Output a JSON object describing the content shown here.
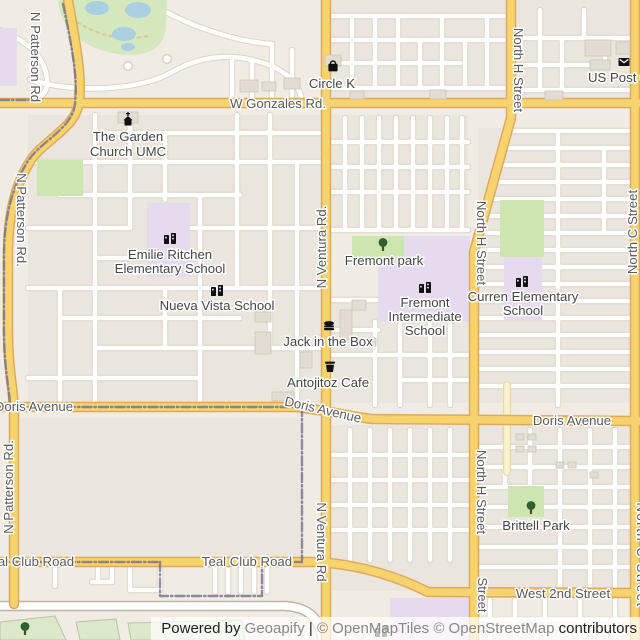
{
  "map": {
    "colors": {
      "background": "#F1ECE3",
      "block": "#EBE6DD",
      "street_fill": "#FFFFFF",
      "street_casing": "#D8D2C7",
      "road_yellow_fill": "#F7D36E",
      "road_yellow_casing": "#E0A85D",
      "road_cream_fill": "#FBF2D0",
      "road_cream_casing": "#E8D9A8",
      "big_road_fill": "#FFFFFF",
      "big_road_casing": "#BBB5A8",
      "park_green": "#CDE5AE",
      "golf_green": "#D5E7BD",
      "field_green": "#DBE8CA",
      "field_outline": "#B8C3A4",
      "school_purple": "#E6DAEF",
      "water_blue": "#A9CFE1",
      "sand_tan": "#D8C8A0",
      "boundary": "#70708F",
      "building_fill": "#E2DCD2",
      "building_outline": "#CBC4B8",
      "street_label_text": "#5A5A5A",
      "poi_label_text": "#454545",
      "icon_black": "#111111",
      "tree_green": "#306030",
      "halo": "#FFFFFF"
    },
    "blocks": [
      [
        332,
        0,
        176,
        100
      ],
      [
        515,
        0,
        121,
        100
      ],
      [
        28,
        115,
        292,
        288
      ],
      [
        332,
        115,
        136,
        115
      ],
      [
        478,
        128,
        156,
        275
      ],
      [
        332,
        300,
        136,
        103
      ],
      [
        332,
        425,
        138,
        166
      ],
      [
        475,
        425,
        159,
        166
      ],
      [
        20,
        418,
        282,
        142
      ]
    ],
    "streets_minor_h": [
      [
        332,
        16,
        508
      ],
      [
        332,
        40,
        508
      ],
      [
        332,
        63,
        460
      ],
      [
        332,
        88,
        508
      ],
      [
        515,
        38,
        634
      ],
      [
        515,
        65,
        600
      ],
      [
        515,
        90,
        634
      ],
      [
        95,
        133,
        320
      ],
      [
        28,
        162,
        320
      ],
      [
        60,
        195,
        240
      ],
      [
        28,
        228,
        130
      ],
      [
        190,
        228,
        320
      ],
      [
        95,
        258,
        200
      ],
      [
        28,
        288,
        320
      ],
      [
        60,
        318,
        240
      ],
      [
        95,
        348,
        320
      ],
      [
        28,
        378,
        200
      ],
      [
        332,
        142,
        468
      ],
      [
        332,
        167,
        468
      ],
      [
        332,
        192,
        468
      ],
      [
        332,
        230,
        468
      ],
      [
        332,
        300,
        378
      ],
      [
        332,
        330,
        378
      ],
      [
        332,
        355,
        470
      ],
      [
        400,
        380,
        470
      ],
      [
        509,
        131,
        634
      ],
      [
        506,
        148,
        634
      ],
      [
        501,
        165,
        634
      ],
      [
        496,
        182,
        634
      ],
      [
        491,
        199,
        634
      ],
      [
        486,
        216,
        634
      ],
      [
        481,
        233,
        634
      ],
      [
        477,
        250,
        634
      ],
      [
        478,
        267,
        634
      ],
      [
        478,
        284,
        634
      ],
      [
        478,
        301,
        634
      ],
      [
        478,
        318,
        634
      ],
      [
        478,
        335,
        634
      ],
      [
        478,
        352,
        634
      ],
      [
        478,
        369,
        634
      ],
      [
        478,
        386,
        634
      ],
      [
        332,
        455,
        470
      ],
      [
        332,
        480,
        470
      ],
      [
        332,
        505,
        470
      ],
      [
        332,
        530,
        470
      ],
      [
        475,
        447,
        634
      ],
      [
        475,
        467,
        634
      ],
      [
        475,
        487,
        634
      ],
      [
        475,
        507,
        634
      ],
      [
        475,
        527,
        634
      ],
      [
        475,
        547,
        634
      ],
      [
        475,
        567,
        634
      ],
      [
        475,
        620,
        630
      ]
    ],
    "streets_minor_v": [
      [
        352,
        16,
        88
      ],
      [
        375,
        16,
        88
      ],
      [
        398,
        16,
        88
      ],
      [
        420,
        40,
        88
      ],
      [
        442,
        16,
        88
      ],
      [
        465,
        40,
        88
      ],
      [
        487,
        16,
        88
      ],
      [
        540,
        10,
        90
      ],
      [
        562,
        38,
        90
      ],
      [
        584,
        10,
        38
      ],
      [
        605,
        38,
        65
      ],
      [
        232,
        58,
        100
      ],
      [
        252,
        60,
        100
      ],
      [
        272,
        46,
        100
      ],
      [
        292,
        50,
        100
      ],
      [
        95,
        115,
        405
      ],
      [
        130,
        115,
        228
      ],
      [
        165,
        133,
        200
      ],
      [
        200,
        195,
        405
      ],
      [
        237,
        115,
        288
      ],
      [
        270,
        115,
        348
      ],
      [
        297,
        162,
        405
      ],
      [
        60,
        288,
        405
      ],
      [
        165,
        288,
        348
      ],
      [
        345,
        118,
        230
      ],
      [
        362,
        118,
        230
      ],
      [
        379,
        118,
        230
      ],
      [
        396,
        118,
        230
      ],
      [
        413,
        118,
        230
      ],
      [
        430,
        118,
        230
      ],
      [
        447,
        118,
        230
      ],
      [
        462,
        118,
        230
      ],
      [
        375,
        322,
        405
      ],
      [
        400,
        322,
        405
      ],
      [
        430,
        322,
        405
      ],
      [
        450,
        322,
        405
      ],
      [
        558,
        131,
        405
      ],
      [
        604,
        148,
        233
      ],
      [
        350,
        430,
        560
      ],
      [
        370,
        430,
        560
      ],
      [
        390,
        430,
        560
      ],
      [
        410,
        430,
        560
      ],
      [
        430,
        430,
        560
      ],
      [
        450,
        430,
        560
      ],
      [
        505,
        430,
        485
      ],
      [
        530,
        430,
        485
      ],
      [
        560,
        430,
        590
      ],
      [
        590,
        430,
        590
      ],
      [
        615,
        430,
        590
      ],
      [
        490,
        600,
        640
      ],
      [
        515,
        600,
        640
      ],
      [
        545,
        600,
        640
      ],
      [
        580,
        600,
        640
      ],
      [
        615,
        600,
        640
      ],
      [
        55,
        566,
        586
      ],
      [
        98,
        566,
        582
      ],
      [
        215,
        566,
        592
      ],
      [
        228,
        566,
        592
      ],
      [
        241,
        566,
        592
      ],
      [
        254,
        566,
        592
      ],
      [
        267,
        566,
        592
      ]
    ],
    "streets_minor_paths": [
      "M0,30 C30,42 44,58 47,78 C49,92 40,100 28,103",
      "M30,80 C80,94 140,90 172,72 C200,56 228,54 252,60 C280,66 300,80 302,103",
      "M150,2 C185,26 238,42 272,44",
      "M130,564 V590 H160 V564",
      "M92,582 H112 V566"
    ],
    "street_bulbs": [
      [
        128,
        66
      ],
      [
        167,
        59
      ]
    ],
    "roads_major": [
      {
        "name": "w-gonzales-rd",
        "d": "M0,103 H640"
      },
      {
        "name": "n-ventura-rd",
        "d": "M326,0 V640"
      },
      {
        "name": "north-h-street",
        "d": "M511,0 V118 L474,252 V640"
      },
      {
        "name": "doris-avenue",
        "d": "M0,407 H295 C325,410 348,416 372,419 L640,421"
      },
      {
        "name": "teal-club-road-west-2nd-street",
        "d": "M0,562 H318 C362,565 398,577 428,592 L640,593"
      },
      {
        "name": "n-patterson-rd",
        "d": "M68,0 C76,45 82,75 79,102 C76,128 44,140 31,160 C15,184 8,215 8,255 L8,330 C8,368 13,388 14,408 L14,604"
      },
      {
        "name": "north-c-street",
        "d": "M635,0 V640"
      }
    ],
    "roads_cream": [
      {
        "name": "minor-tertiary-road",
        "d": "M507,385 V472"
      }
    ],
    "big_road": {
      "name": "wide-road",
      "d": "M0,606 H286 C312,608 321,622 322,640"
    },
    "boundary_paths": [
      "M0,100 H30",
      "M63,4 C72,48 78,77 75,104 C72,129 41,141 28,161 C13,185 4,216 4,256 L4,330 C4,367 9,387 10,404",
      "M0,407 H302",
      "M302,407 V560",
      "M0,562 H160",
      "M160,562 V596 H262 V562",
      "M262,562 H302"
    ],
    "areas": {
      "golf_course": "M58,0 C60,26 78,46 112,53 C142,59 163,52 166,28 L167,0 Z",
      "golf_sand_path": "M72,18 C92,34 120,42 148,36",
      "ponds": [
        [
          97,
          8,
          12,
          7
        ],
        [
          138,
          10,
          13,
          8
        ],
        [
          124,
          34,
          12,
          7
        ],
        [
          128,
          47,
          7,
          4
        ]
      ],
      "parks_rects": [
        {
          "name": "park-mid-left",
          "r": [
            37,
            160,
            46,
            36
          ]
        },
        {
          "name": "fremont-park-green",
          "r": [
            352,
            236,
            57,
            30
          ]
        },
        {
          "name": "green-north-of-curren",
          "r": [
            500,
            200,
            44,
            57
          ]
        },
        {
          "name": "brittell-park-green",
          "r": [
            508,
            486,
            36,
            31
          ]
        }
      ],
      "school_rects": [
        {
          "name": "school-grounds-left-edge",
          "r": [
            0,
            28,
            17,
            58
          ]
        },
        {
          "name": "emilie-ritchen-grounds",
          "r": [
            147,
            203,
            43,
            74
          ]
        },
        {
          "name": "curren-grounds",
          "r": [
            504,
            257,
            38,
            63
          ]
        },
        {
          "name": "school-grounds-bottom",
          "r": [
            390,
            598,
            80,
            42
          ]
        }
      ],
      "school_paths": [
        {
          "name": "fremont-intermediate-grounds",
          "d": "M404,236 H470 V322 H378 V260 L404,256 Z"
        }
      ],
      "fields": [
        [
          [
            0,
            622
          ],
          [
            55,
            616
          ],
          [
            66,
            640
          ],
          [
            0,
            640
          ]
        ],
        [
          [
            76,
            622
          ],
          [
            116,
            619
          ],
          [
            120,
            640
          ],
          [
            80,
            640
          ]
        ],
        [
          [
            128,
            623
          ],
          [
            242,
            620
          ],
          [
            245,
            640
          ],
          [
            131,
            640
          ]
        ]
      ]
    },
    "buildings": [
      [
        240,
        80,
        18,
        12
      ],
      [
        262,
        82,
        14,
        9
      ],
      [
        284,
        78,
        16,
        11
      ],
      [
        350,
        91,
        14,
        8
      ],
      [
        430,
        90,
        16,
        9
      ],
      [
        545,
        91,
        18,
        9
      ],
      [
        585,
        40,
        26,
        16
      ],
      [
        616,
        42,
        14,
        12
      ],
      [
        590,
        60,
        20,
        10
      ],
      [
        325,
        55,
        16,
        11
      ],
      [
        118,
        112,
        20,
        11
      ],
      [
        255,
        312,
        16,
        10
      ],
      [
        255,
        332,
        16,
        22
      ],
      [
        272,
        392,
        22,
        9
      ],
      [
        300,
        352,
        12,
        16
      ],
      [
        340,
        310,
        12,
        30
      ],
      [
        352,
        300,
        14,
        10
      ],
      [
        366,
        338,
        10,
        8
      ],
      [
        516,
        434,
        8,
        6
      ],
      [
        528,
        434,
        8,
        6
      ],
      [
        516,
        446,
        8,
        6
      ],
      [
        528,
        446,
        8,
        6
      ],
      [
        556,
        462,
        8,
        6
      ],
      [
        568,
        462,
        8,
        6
      ],
      [
        590,
        472,
        8,
        6
      ]
    ],
    "street_labels": [
      {
        "t": "W Gonzales Rd.",
        "x": 278,
        "y": 108,
        "mode": "h"
      },
      {
        "t": "Doris Avenue",
        "x": 34,
        "y": 411,
        "mode": "h"
      },
      {
        "t": "Doris Avenue",
        "x": 322,
        "y": 414,
        "mode": "rot",
        "deg": 13
      },
      {
        "t": "Doris Avenue",
        "x": 572,
        "y": 425,
        "mode": "h"
      },
      {
        "t": "Teal Club Road",
        "x": 29,
        "y": 566,
        "mode": "h"
      },
      {
        "t": "Teal Club Road",
        "x": 247,
        "y": 566,
        "mode": "h"
      },
      {
        "t": "West 2nd Street",
        "x": 563,
        "y": 598,
        "mode": "h"
      },
      {
        "t": "N Patterson Rd",
        "x": 31,
        "y": 57,
        "mode": "down"
      },
      {
        "t": "N Patterson Rd.",
        "x": 17,
        "y": 220,
        "mode": "down"
      },
      {
        "t": "N Patterson Rd.",
        "x": 13,
        "y": 487,
        "mode": "up"
      },
      {
        "t": "N Ventura Rd.",
        "x": 326,
        "y": 247,
        "mode": "up"
      },
      {
        "t": "N Ventura Rd",
        "x": 317,
        "y": 542,
        "mode": "down"
      },
      {
        "t": "North H Street",
        "x": 514,
        "y": 70,
        "mode": "down"
      },
      {
        "t": "North H Street",
        "x": 477,
        "y": 243,
        "mode": "down"
      },
      {
        "t": "North H Street",
        "x": 477,
        "y": 492,
        "mode": "down"
      },
      {
        "t": "Street",
        "x": 478,
        "y": 595,
        "mode": "down"
      },
      {
        "t": "North C Street",
        "x": 637,
        "y": 232,
        "mode": "up"
      },
      {
        "t": "North C Street",
        "x": 637,
        "y": 555,
        "mode": "down",
        "ls": 1.5
      }
    ],
    "pois": [
      {
        "name": "circle-k",
        "icon": "bag",
        "ix": 333,
        "iy": 67,
        "lines": [
          {
            "t": "Circle K",
            "x": 332,
            "y": 88
          }
        ]
      },
      {
        "name": "us-post-office",
        "icon": "envelope",
        "ix": 624,
        "iy": 62,
        "lines": [
          {
            "t": "US Post Of",
            "x": 621,
            "y": 82
          }
        ]
      },
      {
        "name": "the-garden-church-umc",
        "icon": "church",
        "ix": 128,
        "iy": 121,
        "lines": [
          {
            "t": "The Garden",
            "x": 128,
            "y": 141
          },
          {
            "t": "Church UMC",
            "x": 128,
            "y": 156
          }
        ]
      },
      {
        "name": "emilie-ritchen-elementary-school",
        "icon": "school",
        "ix": 170,
        "iy": 239,
        "lines": [
          {
            "t": "Emilie Ritchen",
            "x": 170,
            "y": 259
          },
          {
            "t": "Elementary School",
            "x": 170,
            "y": 273
          }
        ]
      },
      {
        "name": "nueva-vista-school",
        "icon": "school",
        "ix": 217,
        "iy": 291,
        "lines": [
          {
            "t": "Nueva Vista School",
            "x": 217,
            "y": 310
          }
        ]
      },
      {
        "name": "fremont-park",
        "icon": "tree",
        "ix": 383,
        "iy": 246,
        "lines": [
          {
            "t": "Fremont park",
            "x": 384,
            "y": 265
          }
        ]
      },
      {
        "name": "fremont-intermediate-school",
        "icon": "school",
        "ix": 425,
        "iy": 288,
        "lines": [
          {
            "t": "Fremont",
            "x": 425,
            "y": 307
          },
          {
            "t": "Intermediate",
            "x": 425,
            "y": 321
          },
          {
            "t": "School",
            "x": 425,
            "y": 335
          }
        ]
      },
      {
        "name": "curren-elementary-school",
        "icon": "school",
        "ix": 522,
        "iy": 282,
        "lines": [
          {
            "t": "Curren Elementary",
            "x": 523,
            "y": 301
          },
          {
            "t": "School",
            "x": 523,
            "y": 315
          }
        ]
      },
      {
        "name": "jack-in-the-box",
        "icon": "burger",
        "ix": 329,
        "iy": 326,
        "lines": [
          {
            "t": "Jack in the Box",
            "x": 328,
            "y": 346
          }
        ]
      },
      {
        "name": "antojitoz-cafe",
        "icon": "cup",
        "ix": 330,
        "iy": 367,
        "lines": [
          {
            "t": "Antojitoz Cafe",
            "x": 328,
            "y": 387
          }
        ]
      },
      {
        "name": "brittell-park",
        "icon": "tree",
        "ix": 531,
        "iy": 509,
        "lines": [
          {
            "t": "Brittell Park",
            "x": 536,
            "y": 530
          }
        ]
      },
      {
        "name": "school-bottom",
        "icon": "school",
        "ix": 381,
        "iy": 632,
        "lines": []
      },
      {
        "name": "field-tree",
        "icon": "tree",
        "ix": 25,
        "iy": 630,
        "lines": []
      }
    ]
  },
  "footer": {
    "segments": [
      {
        "text": "Powered by ",
        "muted": false
      },
      {
        "text": "Geoapify",
        "muted": true,
        "link": true
      },
      {
        "text": " | ",
        "muted": false
      },
      {
        "text": "© OpenMapTiles",
        "muted": true,
        "link": true
      },
      {
        "text": " ",
        "muted": false
      },
      {
        "text": "© OpenStreetMap",
        "muted": true,
        "link": true
      },
      {
        "text": " contributors",
        "muted": false
      }
    ],
    "dark_color": "#1F1F1F",
    "muted_color": "#878787"
  }
}
